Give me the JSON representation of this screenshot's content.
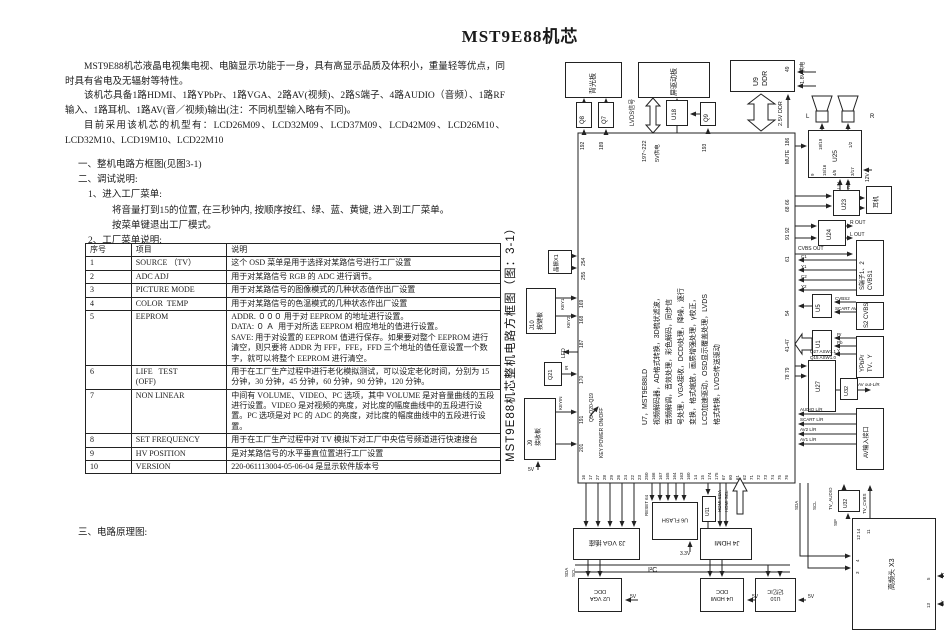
{
  "title": "MST9E88机芯",
  "intro": {
    "p1": "MST9E88机芯液晶电视集电视、电脑显示功能于一身，具有高显示品质及体积小，重量轻等优点，同时具有省电及无辐射等特性。",
    "p2": "该机芯具备1路HDMI、1路YPbPr、1路VGA、2路AV(视频)、2路S端子、4路AUDIO（音频）、1路RF输入、1路耳机、1路AV(音／视频)输出(注：不同机型输入略有不同)。",
    "p3": "目前采用该机芯的机型有：LCD26M09、LCD32M09、LCD37M09、LCD42M09、LCD26M10、LCD32M10、LCD19M10、LCD22M10"
  },
  "sections": {
    "s1": "一、整机电路方框图(见图3-1)",
    "s2": "二、调试说明:",
    "s2_1": "1、进入工厂菜单:",
    "s2_1a": "将音量打到15的位置, 在三秒钟内, 按顺序按红、绿、蓝、黄键, 进入到工厂菜单。",
    "s2_1b": "按菜单键退出工厂模式。",
    "s2_2": "2、工厂菜单说明:",
    "s3": "三、电路原理图:"
  },
  "table": {
    "headers": [
      "序号",
      "项目",
      "说明"
    ],
    "rows": [
      {
        "no": "1",
        "item": "SOURCE （TV）",
        "desc": "这个 OSD 菜单是用于选择对某路信号进行工厂设置"
      },
      {
        "no": "2",
        "item": "ADC ADJ",
        "desc": "用于对某路信号 RGB 的 ADC 进行调节。"
      },
      {
        "no": "3",
        "item": "PICTURE MODE",
        "desc": "用于对某路信号的图像模式的几种状态值作出厂设置"
      },
      {
        "no": "4",
        "item": "COLOR  TEMP",
        "desc": "用于对某路信号的色温模式的几种状态作出厂设置"
      },
      {
        "no": "5",
        "item": "EEPROM",
        "desc": "ADDR. ０００ 用于对 EEPROM 的地址进行设置。\nDATA: ０ Ａ  用于对所选 EEPROM 相应地址的值进行设置。\nSAVE: 用于对设置的 EEPROM 值进行保存。如果要对整个 EEPROM 进行清空，则只要将 ADDR 为 FFF，FFE，FFD 三个地址的值任意设置一个数字，就可以将整个 EEPROM 进行清空。"
      },
      {
        "no": "6",
        "item": "LIFE   TEST\n(OFF)",
        "desc": "用于在工厂生产过程中进行老化模拟测试，可以设定老化时间，分别为 15 分钟，30 分钟，45 分钟，60 分钟，90 分钟，120 分钟。"
      },
      {
        "no": "7",
        "item": "NON LINEAR",
        "desc": "中间有 VOLUME、VIDEO、PC 选项，其中 VOLUME 是对音量曲线的五段进行设置。VIDEO 是对视频的亮度，对比度的幅度曲线中的五段进行设置。PC 选项是对 PC 的 ADC 的亮度，对比度的幅度曲线中的五段进行设置。"
      },
      {
        "no": "8",
        "item": "SET FREQUENCY",
        "desc": "用于在工厂生产过程中对 TV 模拟下对工厂中央信号频道进行快速搜台"
      },
      {
        "no": "9",
        "item": "HV POSITION",
        "desc": "是对某路信号的水平垂直位置进行工厂设置"
      },
      {
        "no": "10",
        "item": "VERSION",
        "desc": "220-061113004-05-06-04 是显示软件版本号"
      }
    ]
  },
  "diagram": {
    "caption": "MST9E88机芯整机电路方框图（图：3-1）",
    "chip_text": "U7，MST9E88LD\n视频解码器，AD格式转换，3D梳状滤波，\n音频解调，音效处理，彩色解码，同步信\n号处理，VGA接收，DCDI处理，降噪，逐行\n变换，格式缩放，画质增强处理，γ校正，\nLCD加速驱动，OSD显示覆盖处理，LVDS\n格式转换，LVDS传送驱动",
    "blocks": {
      "backlight": "背光板",
      "panel": "屏驱动板",
      "ddr": "U9\nDDR",
      "q8": "Q8",
      "q7": "Q7",
      "q9": "Q9",
      "u18": "U18",
      "u25": "U25",
      "u23": "U23",
      "u24": "U24",
      "phones": "耳机",
      "sconn": "S端子1、2\nCVBS1",
      "s2conn": "S2 CVBS",
      "ypbpr": "YPbPr\nTV、Y",
      "u5": "U5",
      "u1": "U1",
      "u27": "U27",
      "u32": "U32",
      "avif": "AV输入接口",
      "crystal": "晶振X1",
      "keypad": "J10\n按键板",
      "irboard": "J9\n接收板",
      "q21": "Q21",
      "j3": "J3 VGA 插座",
      "flash": "U6 FLASH",
      "j4": "J4 HDMI",
      "u11": "U11",
      "u2": "U2 VGA\nDDC",
      "u4": "U4 HDMI\nDDC",
      "u10": "U10\n记忆IC",
      "tuner": "高频头 X3",
      "u32b": "U32"
    },
    "labels": {
      "lvds": "LVDS信号",
      "bus197": "197~222",
      "v5u18": "5V供电",
      "v18": "1.8V供电",
      "v25": "2.5V DDR",
      "mute": "MUTE",
      "v12": "12V",
      "lin": "LIN",
      "rin": "RIN",
      "rout": "R OUT",
      "lout": "L OUT",
      "cvbs_out": "CVBS OUT",
      "c1": "C1",
      "y1": "Y1",
      "c2": "C2",
      "y2": "Y2",
      "cvbs2": "CVBS2",
      "scart_av": "SCART AV",
      "pr": "Pr",
      "pb": "Pb",
      "y": "Y",
      "audio_lr": "AUDIO L/R",
      "scart_lr": "SCART L/R",
      "av2_lr": "AV2 L/R",
      "av1_lr": "AV1 L/R",
      "av_out": "AV out-L/R",
      "q27": "Q27 ASW1.1",
      "q15": "Q15 ASW1.0",
      "key1": "KEY1",
      "key2": "KEY2",
      "keyin": "KEYIN",
      "led": "LED",
      "ir": "IR",
      "q5": "Q5-Q20-Q19",
      "key_power": "KEY POWER ON/OFF",
      "v5j9": "5V",
      "i2c": "I²C",
      "sda": "SDA",
      "scl": "SCL",
      "sda2": "SDA",
      "scl2": "SCL",
      "hdmi_sda": "HDMI SDA",
      "hdmi_scl": "HDMI SCL",
      "reset": "RESET 64",
      "v33": "3.3V",
      "v5u2": "5V",
      "v5u4": "5V",
      "v5u10": "5V",
      "tv_cvbs": "TV_CVBS",
      "tv_audio": "TV_AUDIO",
      "sif": "SIF",
      "vt": "VT",
      "v5t": "5V",
      "spk_l": "L",
      "spk_r": "R"
    },
    "pins": {
      "bottom": [
        "16",
        "17",
        "27",
        "28",
        "29",
        "26",
        "24",
        "22",
        "23",
        "250",
        "166",
        "167",
        "165",
        "164",
        "163",
        "160",
        "14",
        "15",
        "174",
        "175",
        "67",
        "60",
        "61",
        "62",
        "71",
        "72",
        "73",
        "74",
        "75",
        "76"
      ],
      "left": [
        "254",
        "255",
        "169",
        "168",
        "187",
        "170",
        "191",
        "201"
      ],
      "right": [
        "186",
        "68 66",
        "91 92",
        "61",
        "54",
        "41-47",
        "78 79"
      ],
      "top": [
        "192",
        "189",
        "193"
      ],
      "ddr": "49",
      "u25t1": "18/19",
      "u25t2": "1/2",
      "u25b1": "9",
      "u25b2": "15/16",
      "u25b3": "4/5",
      "u25b4": "3/17",
      "t1": "12 14",
      "t2": "11",
      "t3": "4",
      "t4": "3",
      "t5": "5",
      "t6": "13"
    }
  }
}
